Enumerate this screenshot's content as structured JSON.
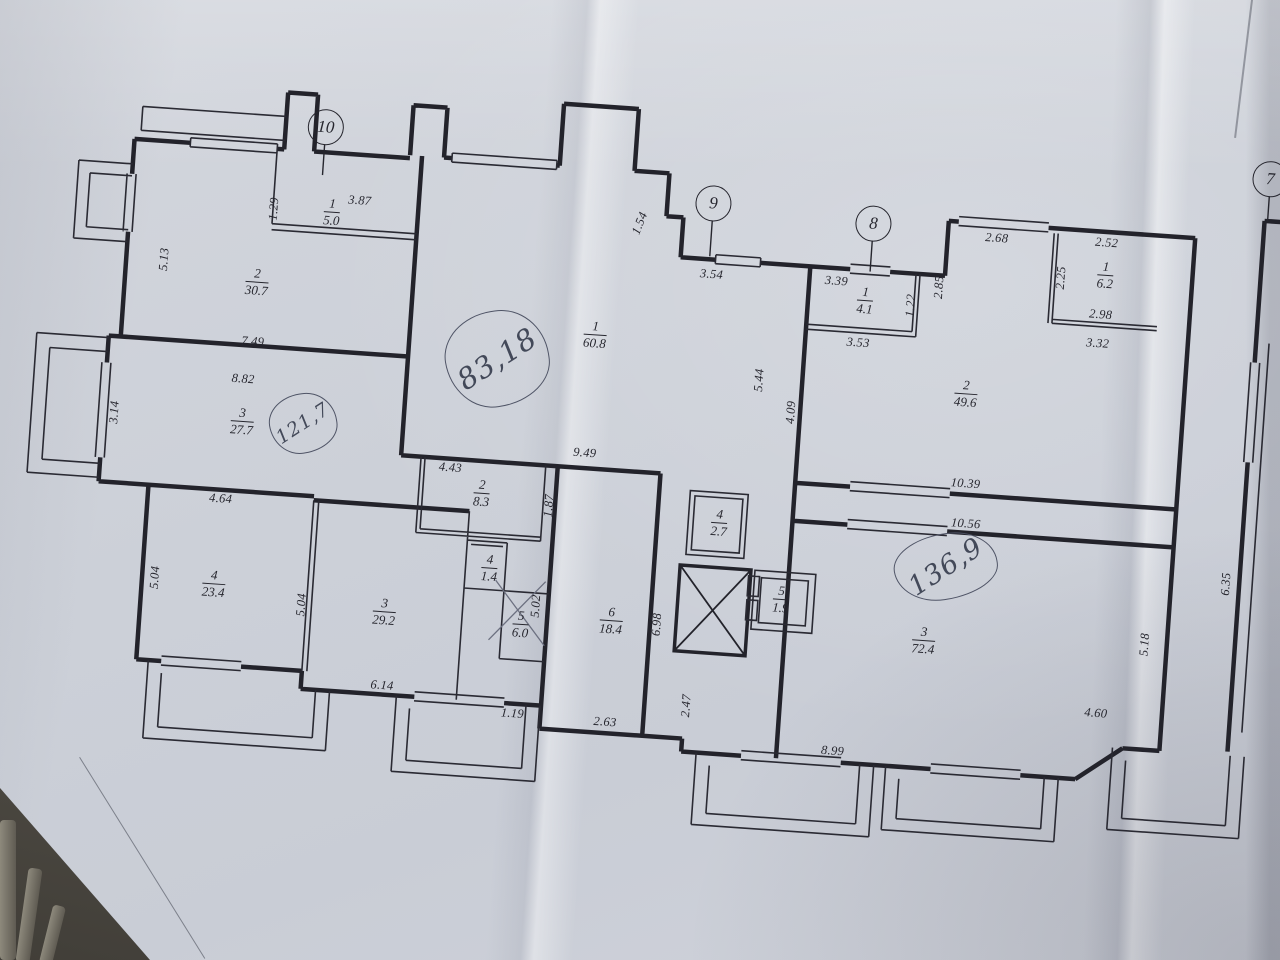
{
  "plan": {
    "sheet": "apartment floor plan, photographed paper drawing",
    "axis_markers": [
      {
        "label": "10"
      },
      {
        "label": "9"
      },
      {
        "label": "8"
      },
      {
        "label": "7"
      }
    ],
    "handwritten_totals": [
      {
        "value": "83,18"
      },
      {
        "value": "121,7"
      },
      {
        "value": "136,9"
      }
    ],
    "rooms": [
      {
        "num": "1",
        "area": "5.0"
      },
      {
        "num": "2",
        "area": "30.7"
      },
      {
        "num": "3",
        "area": "27.7"
      },
      {
        "num": "4",
        "area": "23.4"
      },
      {
        "num": "3",
        "area": "29.2"
      },
      {
        "num": "2",
        "area": "8.3"
      },
      {
        "num": "4",
        "area": "1.4"
      },
      {
        "num": "5",
        "area": "6.0"
      },
      {
        "num": "6",
        "area": "18.4"
      },
      {
        "num": "1",
        "area": "60.8"
      },
      {
        "num": "4",
        "area": "2.7"
      },
      {
        "num": "5",
        "area": "1.9"
      },
      {
        "num": "1",
        "area": "4.1"
      },
      {
        "num": "2",
        "area": "49.6"
      },
      {
        "num": "1",
        "area": "6.2"
      },
      {
        "num": "3",
        "area": "72.4"
      },
      {
        "num": "1",
        "area": "4.5"
      }
    ],
    "dimensions": [
      {
        "value": "3.87"
      },
      {
        "value": "1.29"
      },
      {
        "value": "5.13"
      },
      {
        "value": "7.49"
      },
      {
        "value": "8.82"
      },
      {
        "value": "3.14"
      },
      {
        "value": "4.64"
      },
      {
        "value": "5.04"
      },
      {
        "value": "5.04"
      },
      {
        "value": "6.14"
      },
      {
        "value": "1.19"
      },
      {
        "value": "5.02"
      },
      {
        "value": "1.87"
      },
      {
        "value": "4.43"
      },
      {
        "value": "9.49"
      },
      {
        "value": "2.63"
      },
      {
        "value": "6.98"
      },
      {
        "value": "2.47"
      },
      {
        "value": "1.54"
      },
      {
        "value": "3.54"
      },
      {
        "value": "3.39"
      },
      {
        "value": "5.44"
      },
      {
        "value": "4.09"
      },
      {
        "value": "3.53"
      },
      {
        "value": "1.22"
      },
      {
        "value": "2.85"
      },
      {
        "value": "2.68"
      },
      {
        "value": "2.52"
      },
      {
        "value": "2.25"
      },
      {
        "value": "2.98"
      },
      {
        "value": "3.32"
      },
      {
        "value": "10.39"
      },
      {
        "value": "10.56"
      },
      {
        "value": "5.18"
      },
      {
        "value": "4.60"
      },
      {
        "value": "8.99"
      },
      {
        "value": "6.35"
      }
    ]
  }
}
